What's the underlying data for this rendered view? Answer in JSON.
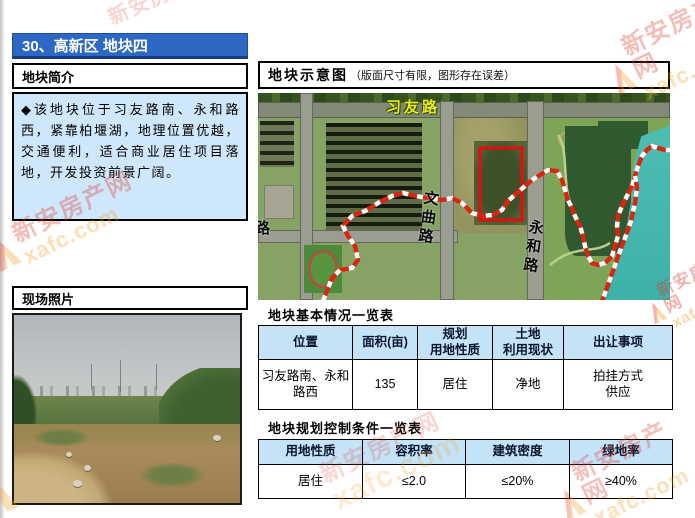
{
  "page": {
    "title": "30、高新区 地块四"
  },
  "left": {
    "intro": {
      "header": "地块简介",
      "body": "◆该地块位于习友路南、永和路西，紧靠柏堰湖，地理位置优越，交通便利，适合商业居住项目落地，开发投资前景广阔。"
    },
    "photo": {
      "header": "现场照片"
    }
  },
  "right": {
    "map": {
      "header": "地块示意图",
      "note": "（版面尺寸有限，图形存在误差）",
      "labels": {
        "top_road": "习友路",
        "mid_road": "文曲路",
        "right_road": "永和路",
        "left_road_partial": "路"
      }
    },
    "table1": {
      "title": "地块基本情况一览表",
      "headers": [
        "位置",
        "面积(亩)",
        "规划\n用地性质",
        "土地\n利用现状",
        "出让事项"
      ],
      "row": [
        "习友路南、永和\n路西",
        "135",
        "居住",
        "净地",
        "拍挂方式\n供应"
      ]
    },
    "table2": {
      "title": "地块规划控制条件一览表",
      "headers": [
        "用地性质",
        "容积率",
        "建筑密度",
        "绿地率"
      ],
      "row": [
        "居住",
        "≤2.0",
        "≤20%",
        "≥40%"
      ]
    }
  },
  "watermark": {
    "cn": "新安房产网",
    "en": "xafc.com"
  },
  "colors": {
    "title_bar_blue": "#2d68c4",
    "intro_bg_blue": "#cfe7fa",
    "table_header_blue": "#c5e3f7",
    "parcel_boundary_red": "#e01010",
    "road_label_yellow": "#f0e61c",
    "water_teal": "#45bdb2",
    "watermark_red": "#e03524",
    "watermark_orange": "#f59d1e"
  }
}
